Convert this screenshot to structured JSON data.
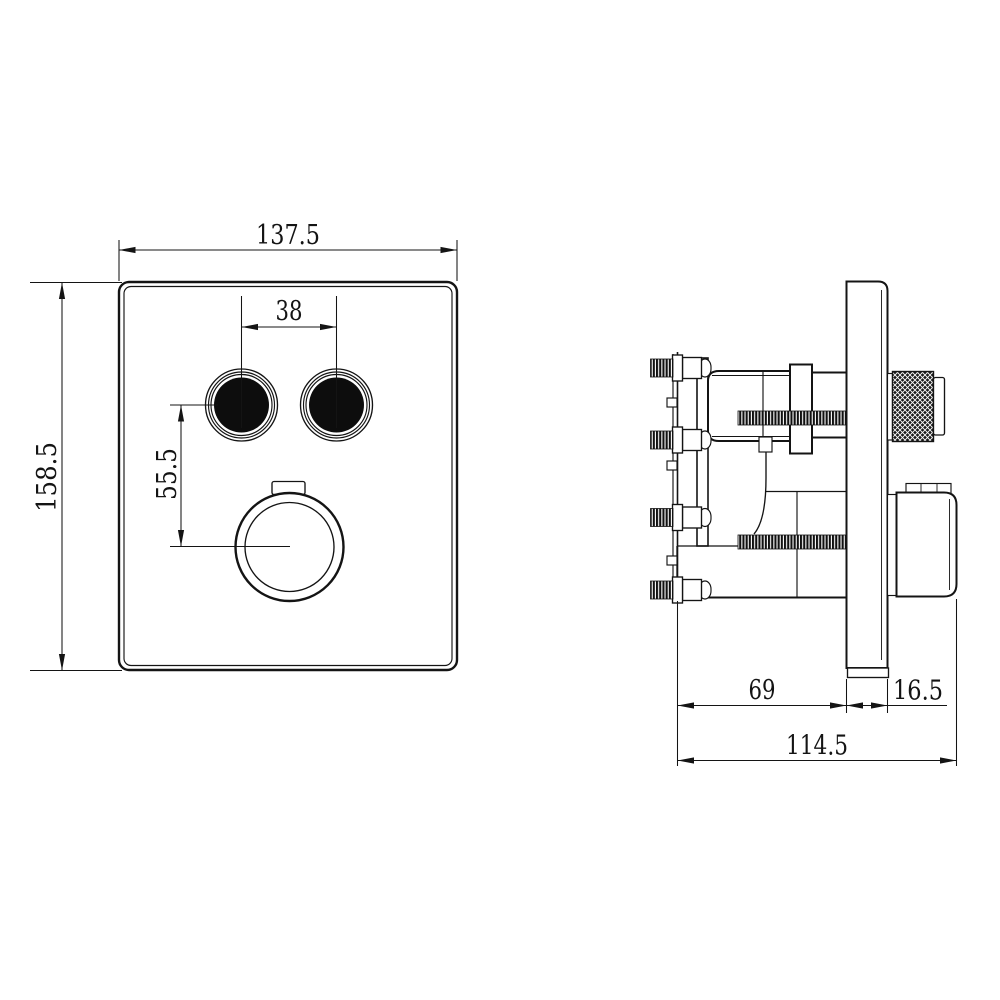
{
  "drawing": {
    "background": "#ffffff",
    "line_color": "#141414",
    "views": {
      "front": {
        "name": "front-view",
        "dimensions": {
          "overall_width": "137.5",
          "overall_height": "158.5",
          "button_spacing": "38",
          "buttons_to_knob": "55.5"
        }
      },
      "side": {
        "name": "side-view",
        "dimensions": {
          "body_depth": "69",
          "trim_plate_thickness": "16.5",
          "overall_depth": "114.5"
        }
      }
    }
  }
}
